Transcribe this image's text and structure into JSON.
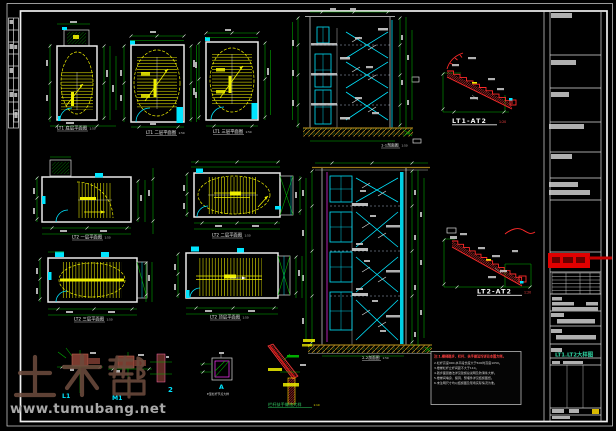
{
  "watermark": {
    "brand": "土木帮",
    "url": "www.tumubang.net"
  },
  "plans": {
    "p1": {
      "label": "LT1 底层平面图",
      "scale": "1:50"
    },
    "p2": {
      "label": "LT1 二层平面图",
      "scale": "1:50"
    },
    "p3": {
      "label": "LT1 三层平面图",
      "scale": "1:50"
    },
    "p4": {
      "label": "LT2 一层平面图",
      "scale": "1:50"
    },
    "p5": {
      "label": "LT2 二层平面图",
      "scale": "1:50"
    },
    "p6": {
      "label": "LT2 三层平面图",
      "scale": "1:50"
    },
    "p7": {
      "label": "LT2 顶层平面图",
      "scale": "1:50"
    }
  },
  "sections": {
    "s1": {
      "label": "1-1剖面图",
      "scale": "1:50"
    },
    "s2": {
      "label": "2-2剖面图",
      "scale": "1:50"
    }
  },
  "details": {
    "d1": {
      "label": "LT1-AT2",
      "scale": "1:20"
    },
    "d2": {
      "label": "LT2-AT2",
      "scale": "1:20"
    },
    "handrail": {
      "label": "栏杆扶手做法大样",
      "scale": "1:10"
    },
    "node_a": {
      "tag": "A",
      "caption": "E型栏杆节点大样"
    },
    "tag_l1": "L1",
    "tag_m1": "M1",
    "tag_2": "2"
  },
  "notes": {
    "title": "注:1.楼梯踏步、栏杆、扶手做法均详见本图大样。",
    "body": "2.栏杆高度900,水平段长度大于500时高度1050。\n3.楼梯栏杆立杆间距不大于110。\n4.踏步面层做法详见建施总说明及防滑条大样。\n5.楼梯间墙身、留洞、预埋件详见结施图纸。\n6.未注明尺寸均以结施图及现场实际情况为准。"
  },
  "titleblock": {
    "drawing_name": "LT1.LT2大样图"
  }
}
